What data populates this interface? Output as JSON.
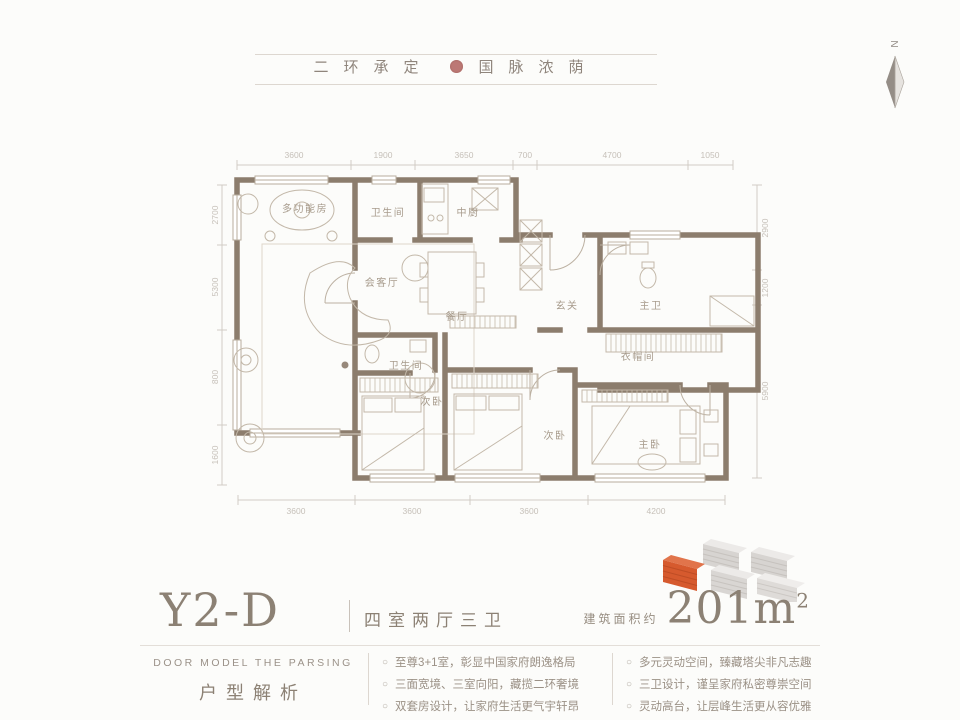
{
  "header": {
    "slogan_left": "二环承定",
    "slogan_right": "国脉浓荫",
    "compass_label": "N"
  },
  "plan": {
    "rooms": {
      "multi_room": "多功能房",
      "bath_top": "卫生间",
      "kitchen": "中厨",
      "living": "会客厅",
      "dining": "餐厅",
      "foyer": "玄关",
      "master_bath": "主卫",
      "cloakroom": "衣帽间",
      "bath_small": "卫生间",
      "bedroom2": "次卧",
      "bedroom3": "次卧",
      "master_bedroom": "主卧"
    },
    "dims_top": [
      "3600",
      "1900",
      "3650",
      "700",
      "4700",
      "1050"
    ],
    "dims_bottom": [
      "3600",
      "3600",
      "3600",
      "4200"
    ],
    "dims_left": [
      "2700",
      "5300",
      "800",
      "1600"
    ],
    "dims_right": [
      "2900",
      "1200",
      "5900"
    ]
  },
  "title": {
    "model": "Y2-D",
    "layout": "四室两厅三卫",
    "area_prefix": "建筑面积约",
    "area_value": "201m",
    "area_sup": "2"
  },
  "footer": {
    "left_en": "DOOR MODEL THE PARSING",
    "left_cn": "户型解析",
    "bullet": "○",
    "col1": [
      "至尊3+1室，彰显中国家府朗逸格局",
      "三面宽境、三室向阳，藏揽二环奢境",
      "双套房设计，让家府生活更气宇轩昂"
    ],
    "col2": [
      "多元灵动空间，臻藏塔尖非凡志趣",
      "三卫设计，谨呈家府私密尊崇空间",
      "灵动高台，让层峰生活更从容优雅"
    ]
  },
  "colors": {
    "wall": "#8c7d6d",
    "accent_orange": "#d65a2e",
    "muted_text": "#9b9186"
  }
}
